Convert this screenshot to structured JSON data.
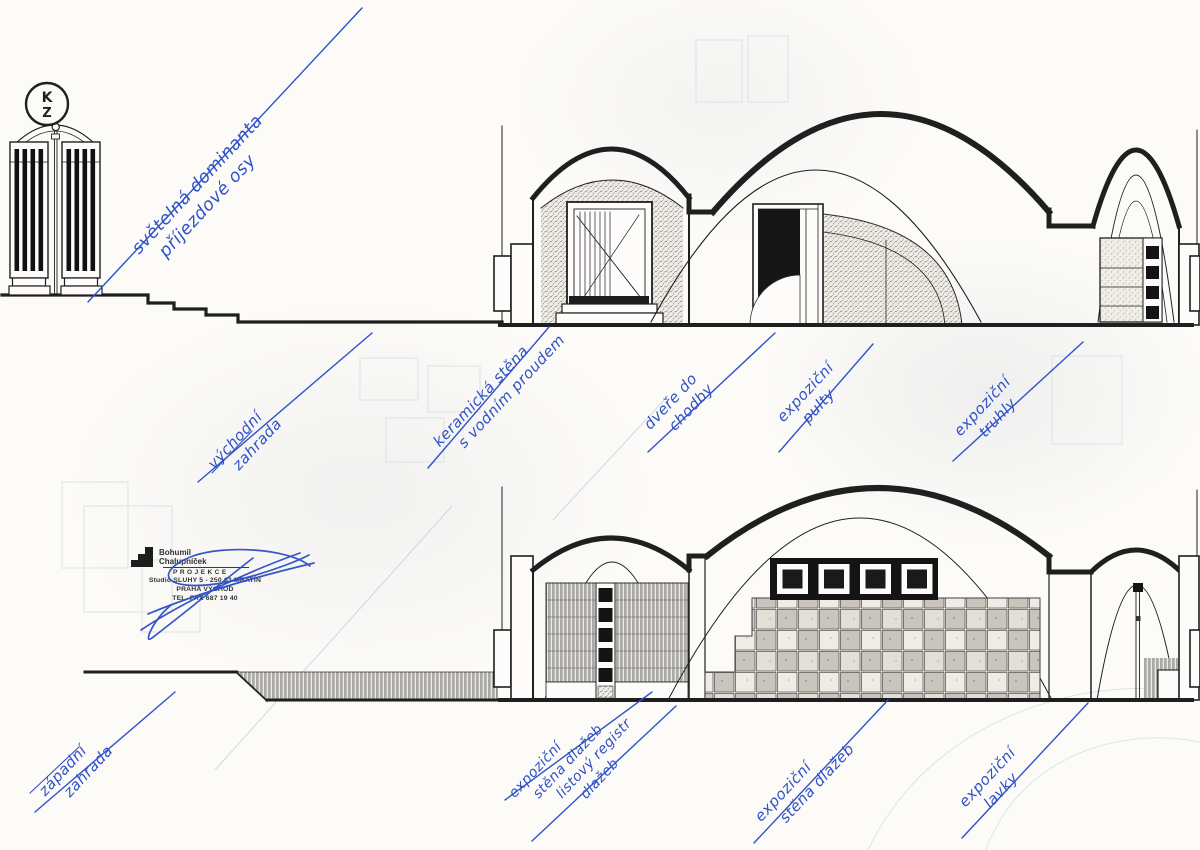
{
  "logo": {
    "top": "K",
    "bottom": "Z"
  },
  "annotations": [
    {
      "id": "svetelna-dominanta",
      "lines": [
        "světelná dominanta",
        "příjezdové osy"
      ]
    },
    {
      "id": "vychodni-zahrada",
      "lines": [
        "východní",
        "zahrada"
      ]
    },
    {
      "id": "keramicka-stena",
      "lines": [
        "keramická stěna",
        "s vodním proudem"
      ]
    },
    {
      "id": "dvere-do-chodby",
      "lines": [
        "dveře do",
        "chodby"
      ]
    },
    {
      "id": "expozicni-pulty",
      "lines": [
        "expoziční",
        "pulty"
      ]
    },
    {
      "id": "expozicni-truhly",
      "lines": [
        "expoziční",
        "truhly"
      ]
    },
    {
      "id": "zapadni-zahrada",
      "lines": [
        "západní",
        "zahrada"
      ]
    },
    {
      "id": "expozicni-stena-registr",
      "lines": [
        "expoziční",
        "stěna dlažeb",
        "listový registr",
        "dlažeb"
      ]
    },
    {
      "id": "expozicni-stena-dlazeb",
      "lines": [
        "expoziční",
        "stěna dlažeb"
      ]
    },
    {
      "id": "expozicni-lavky",
      "lines": [
        "expoziční",
        "lavky"
      ]
    }
  ],
  "stamp": {
    "name_top": "Bohumil",
    "name_bottom": "Chalupníček",
    "role": "PROJEKCE",
    "address": "Studio SLUHY 5 - 250 63 MRATÍN",
    "city": "PRAHA VÝCHOD",
    "phone": "TEL. FAX 687 19 40"
  },
  "colors": {
    "annotation_blue": "#2f52c8",
    "drawing_ink": "#1f1f1f",
    "paper": "#fcfbf8"
  }
}
